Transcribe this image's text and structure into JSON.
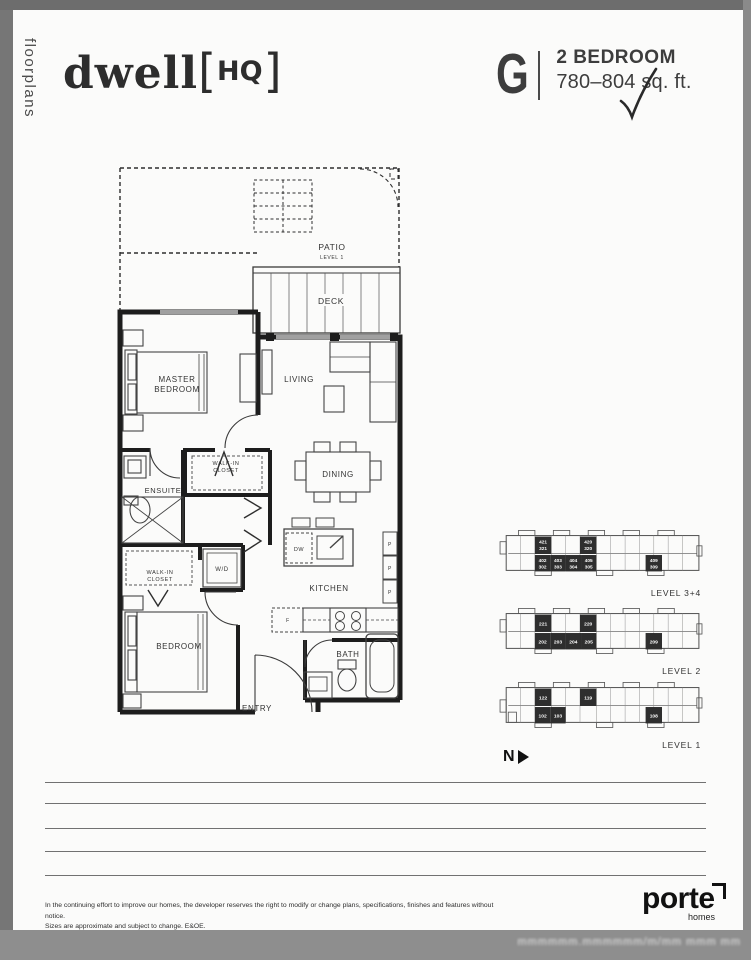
{
  "sidebar": {
    "label": "floorplans"
  },
  "header": {
    "brand": "dwell",
    "bracket_open": "[",
    "brand_tag": "HQ",
    "bracket_close": "]",
    "plan_letter": "G",
    "plan_type": "2 BEDROOM",
    "plan_size": "780–804 sq. ft."
  },
  "colors": {
    "frame_gray": "#767676",
    "bottom_bar_gray": "#8e8e8e",
    "wall_black": "#1d1d1d",
    "keyplan_unit_fill": "#2e2e2e"
  },
  "floorplan": {
    "labels": {
      "patio": "PATIO",
      "patio_sub": "LEVEL 1",
      "deck": "DECK",
      "master_1": "MASTER",
      "master_2": "BEDROOM",
      "living": "LIVING",
      "walkin_1": "WALK-IN",
      "walkin_2": "CLOSET",
      "ensuite": "ENSUITE",
      "dining": "DINING",
      "wd": "W/D",
      "kitchen": "KITCHEN",
      "dw": "DW",
      "fridge": "F",
      "pantry": "P",
      "bedroom": "BEDROOM",
      "bath": "BATH",
      "entry": "ENTRY"
    }
  },
  "keyplans": [
    {
      "label": "LEVEL 3+4",
      "top_units": [
        [
          "421",
          "321"
        ],
        [
          "420",
          "320"
        ]
      ],
      "bottom_units": [
        [
          "402",
          "302"
        ],
        [
          "403",
          "303"
        ],
        [
          "404",
          "304"
        ],
        [
          "405",
          "305"
        ]
      ],
      "right_unit": [
        "409",
        "309"
      ]
    },
    {
      "label": "LEVEL 2",
      "top_units": [
        [
          "221"
        ],
        [
          "220"
        ]
      ],
      "bottom_units": [
        [
          "202"
        ],
        [
          "203"
        ],
        [
          "204"
        ],
        [
          "205"
        ]
      ],
      "right_unit": [
        "209"
      ]
    },
    {
      "label": "LEVEL 1",
      "top_units": [
        [
          "122"
        ],
        [
          "119"
        ]
      ],
      "bottom_units": [
        [
          "102"
        ],
        [
          "103"
        ]
      ],
      "right_unit": [
        "108"
      ]
    }
  ],
  "north": {
    "label": "N"
  },
  "disclaimer": {
    "line1": "In the continuing effort to improve our homes, the developer reserves the right to modify or change plans, specifications, finishes and features without notice.",
    "line2": "Sizes are approximate and subject to change. E&OE."
  },
  "footer_brand": {
    "name": "porte",
    "sub": "homes"
  },
  "watermark": "mmmmmm.mmmmmm/m/mm mmm mm"
}
